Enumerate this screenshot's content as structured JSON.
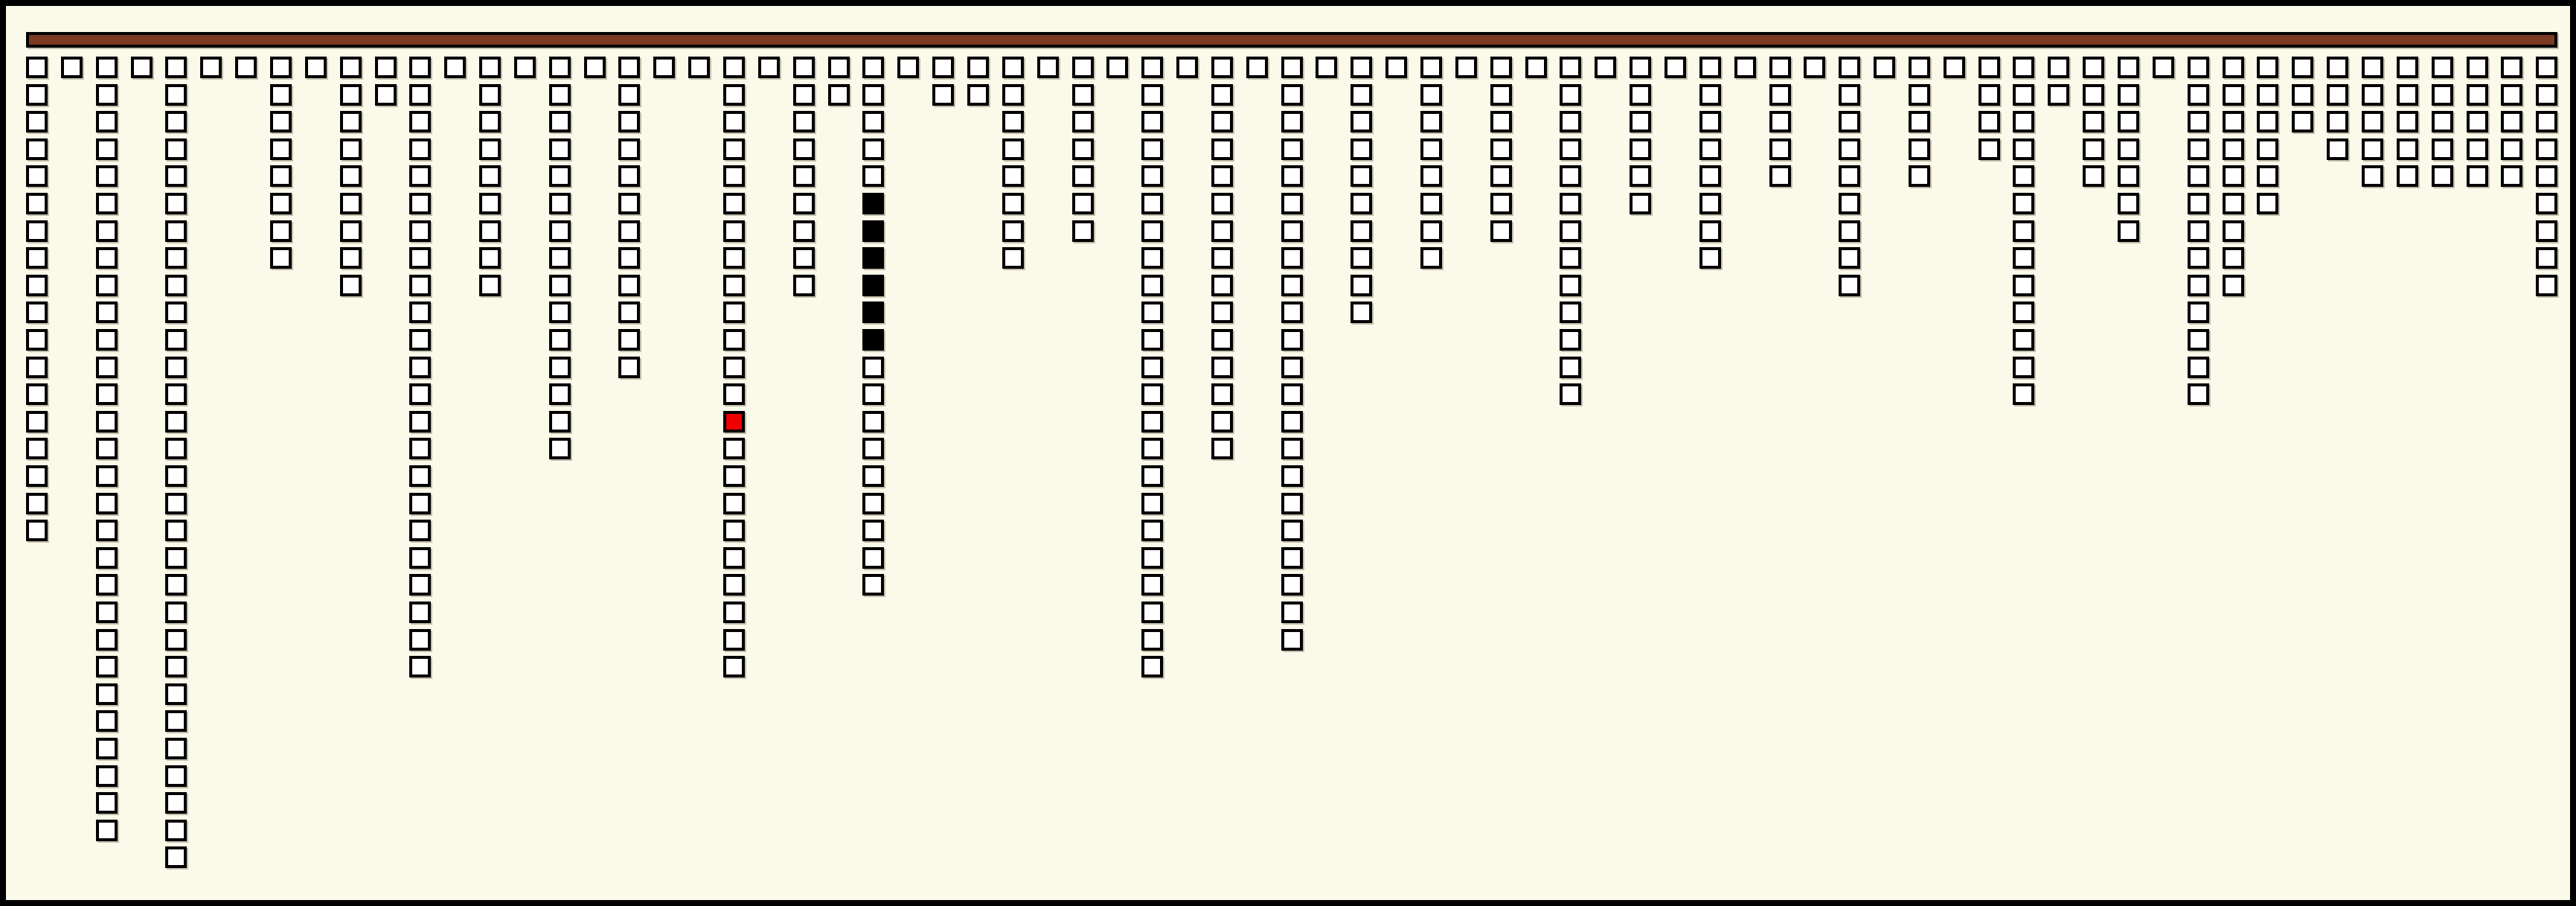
{
  "colors": {
    "background": "#fbf9ea",
    "frame": "#000000",
    "bar_fill": "#7b3a22",
    "bar_border": "#000000",
    "cell_fill": "#ffffff",
    "cell_border": "#000000",
    "red_cell": "#ee0000",
    "black_cell": "#000000",
    "shadow": "rgba(125,120,100,0.45)"
  },
  "board": {
    "num_columns": 73,
    "max_rows": 30,
    "column_heights": [
      18,
      1,
      29,
      1,
      30,
      1,
      1,
      8,
      1,
      9,
      2,
      23,
      1,
      9,
      1,
      15,
      1,
      12,
      1,
      1,
      23,
      1,
      9,
      2,
      20,
      1,
      2,
      2,
      8,
      1,
      7,
      1,
      23,
      1,
      15,
      1,
      22,
      1,
      10,
      1,
      8,
      1,
      7,
      1,
      13,
      1,
      6,
      1,
      8,
      1,
      5,
      1,
      9,
      1,
      5,
      1,
      4,
      13,
      2,
      5,
      7,
      1,
      13,
      9,
      6,
      3,
      4,
      5,
      5,
      5,
      5,
      5,
      9
    ],
    "special_cells": [
      {
        "column": 21,
        "row": 14,
        "color_name": "red"
      },
      {
        "column": 25,
        "rows": [
          6,
          7,
          8,
          9,
          10,
          11
        ],
        "color_name": "black"
      }
    ]
  }
}
